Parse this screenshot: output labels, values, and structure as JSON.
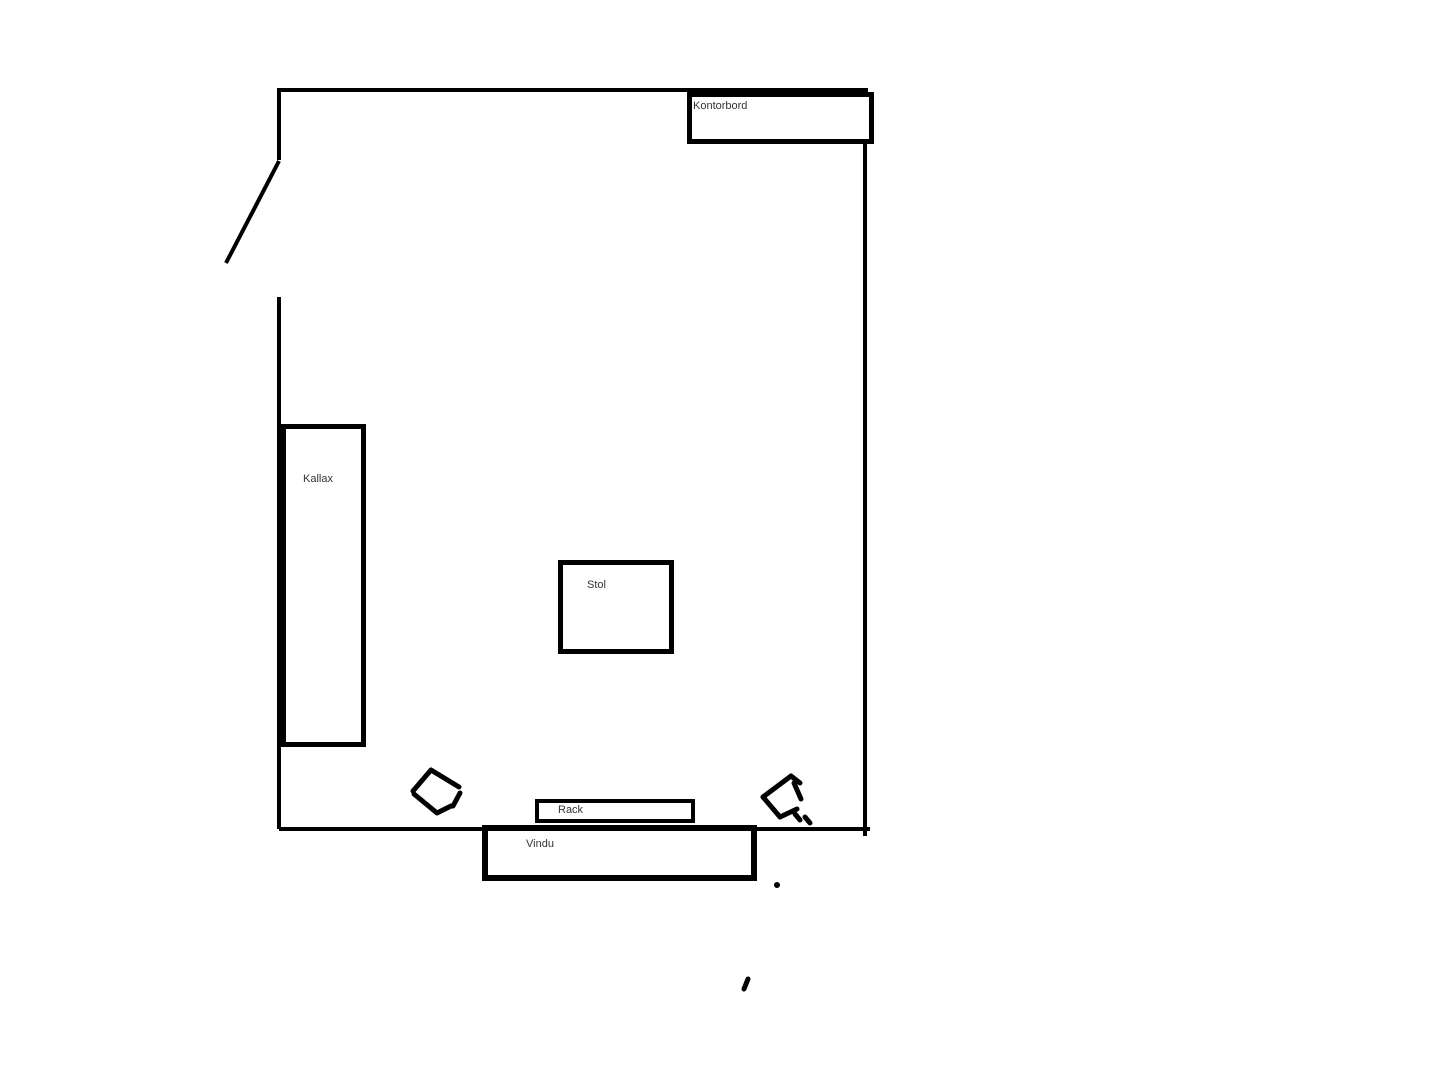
{
  "diagram": {
    "type": "floor-plan-sketch",
    "background_color": "#ffffff",
    "wall_color": "#000000",
    "label_color": "#33333d"
  },
  "labels": {
    "kontorbord": "Kontorbord",
    "kallax": "Kallax",
    "stol": "Stol",
    "rack": "Rack",
    "vindu": "Vindu"
  }
}
